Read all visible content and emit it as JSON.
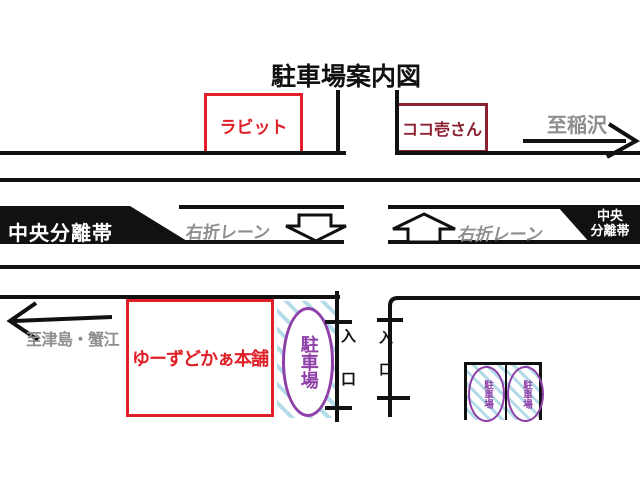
{
  "title": "駐車場案内図",
  "landmarks": {
    "rabbit": "ラビット",
    "cocoichi": "ココ壱さん",
    "shop": "ゆーずどかぁ本舗"
  },
  "directions": {
    "east": "至稲沢",
    "west": "至津島・蟹江"
  },
  "road": {
    "median_left": "中央分離帯",
    "median_right_line1": "中央",
    "median_right_line2": "分離帯",
    "turn_lane_left": "右折レーン",
    "turn_lane_right": "右折レーン"
  },
  "parking": {
    "main": "駐車場",
    "stall_1": "駐車場",
    "stall_2": "駐車場",
    "entrance_left": "入口",
    "entrance_right": "入口"
  },
  "colors": {
    "landmark_red": "#e02028",
    "landmark_maroon": "#8b2030",
    "direction_gray": "#8e8e8e",
    "parking_purple": "#8e3fa8",
    "hatch_blue": "#b3dce8",
    "line_black": "#111111"
  }
}
